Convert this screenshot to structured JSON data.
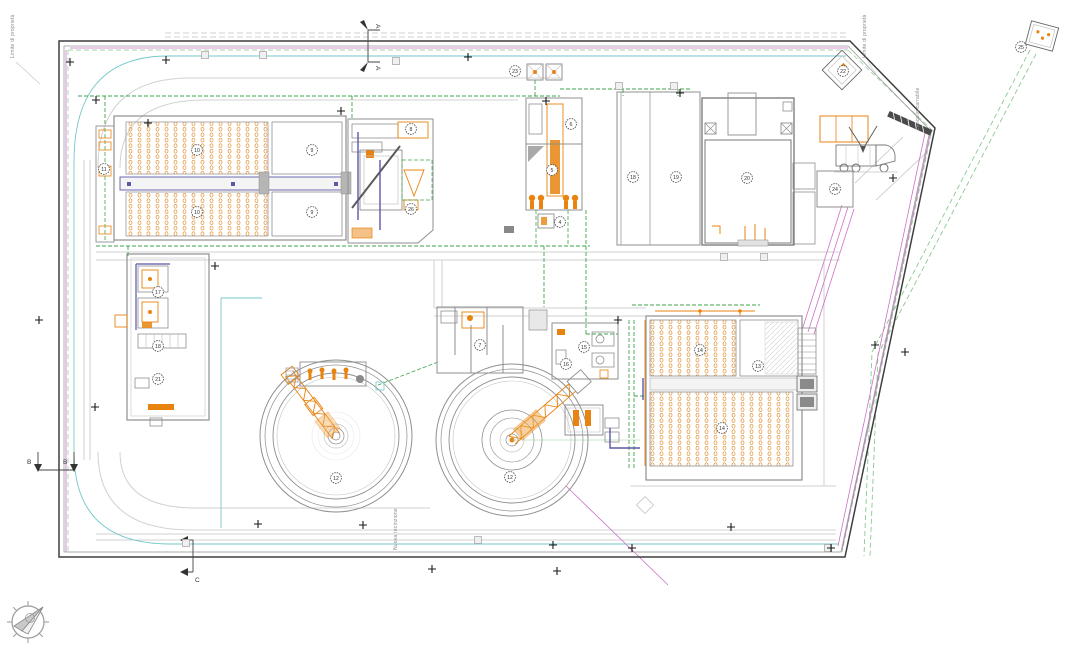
{
  "labels": {
    "boundary_left": "Limite di proprietà",
    "boundary_right": "Limite di proprietà",
    "fence": "Nuova recinzione",
    "gate": "cancello carrabile",
    "section_a": "A",
    "section_b": "B",
    "section_c": "C"
  },
  "colors": {
    "boundary": "#3F3F3F",
    "equipment_orange": "#E8830F",
    "diffuser_orange": "#E09032",
    "pipe_green": "#3DA44A",
    "cable_magenta": "#CC72C8",
    "line_cyan": "#74C8C8",
    "walkway_purple": "#5B58A8",
    "structure_gray": "#8F8F8F",
    "road_gray": "#D2D2D2"
  },
  "equipment_tags": [
    {
      "id": "11",
      "x": 104,
      "y": 169
    },
    {
      "id": "10",
      "x": 197,
      "y": 150
    },
    {
      "id": "10",
      "x": 197,
      "y": 212
    },
    {
      "id": "9",
      "x": 312,
      "y": 150
    },
    {
      "id": "9",
      "x": 312,
      "y": 212
    },
    {
      "id": "8",
      "x": 411,
      "y": 129
    },
    {
      "id": "26",
      "x": 411,
      "y": 209
    },
    {
      "id": "23",
      "x": 515,
      "y": 71
    },
    {
      "id": "6",
      "x": 571,
      "y": 124
    },
    {
      "id": "5",
      "x": 552,
      "y": 170
    },
    {
      "id": "4",
      "x": 560,
      "y": 222
    },
    {
      "id": "18",
      "x": 633,
      "y": 177
    },
    {
      "id": "19",
      "x": 676,
      "y": 177
    },
    {
      "id": "20",
      "x": 747,
      "y": 178
    },
    {
      "id": "22",
      "x": 843,
      "y": 71
    },
    {
      "id": "24",
      "x": 835,
      "y": 189
    },
    {
      "id": "25",
      "x": 1021,
      "y": 47
    },
    {
      "id": "17",
      "x": 158,
      "y": 292
    },
    {
      "id": "18",
      "x": 158,
      "y": 346
    },
    {
      "id": "21",
      "x": 158,
      "y": 379
    },
    {
      "id": "7",
      "x": 480,
      "y": 345
    },
    {
      "id": "15",
      "x": 584,
      "y": 347
    },
    {
      "id": "16",
      "x": 566,
      "y": 364
    },
    {
      "id": "12",
      "x": 336,
      "y": 478
    },
    {
      "id": "12",
      "x": 510,
      "y": 477
    },
    {
      "id": "14",
      "x": 700,
      "y": 350
    },
    {
      "id": "13",
      "x": 758,
      "y": 366
    },
    {
      "id": "14",
      "x": 722,
      "y": 428
    }
  ],
  "survey_crosses": [
    [
      148,
      123
    ],
    [
      96,
      100
    ],
    [
      70,
      62
    ],
    [
      166,
      60
    ],
    [
      215,
      266
    ],
    [
      341,
      111
    ],
    [
      468,
      57
    ],
    [
      546,
      101
    ],
    [
      618,
      320
    ],
    [
      680,
      93
    ],
    [
      893,
      178
    ],
    [
      875,
      345
    ],
    [
      905,
      352
    ],
    [
      39,
      320
    ],
    [
      95,
      407
    ],
    [
      258,
      524
    ],
    [
      363,
      525
    ],
    [
      432,
      569
    ],
    [
      553,
      545
    ],
    [
      557,
      571
    ],
    [
      632,
      548
    ],
    [
      731,
      527
    ],
    [
      831,
      548
    ]
  ],
  "monuments": [
    [
      205,
      55
    ],
    [
      263,
      55
    ],
    [
      396,
      61
    ],
    [
      186,
      543
    ],
    [
      478,
      540
    ],
    [
      828,
      548
    ],
    [
      724,
      257
    ],
    [
      764,
      257
    ],
    [
      619,
      86
    ],
    [
      674,
      86
    ]
  ]
}
